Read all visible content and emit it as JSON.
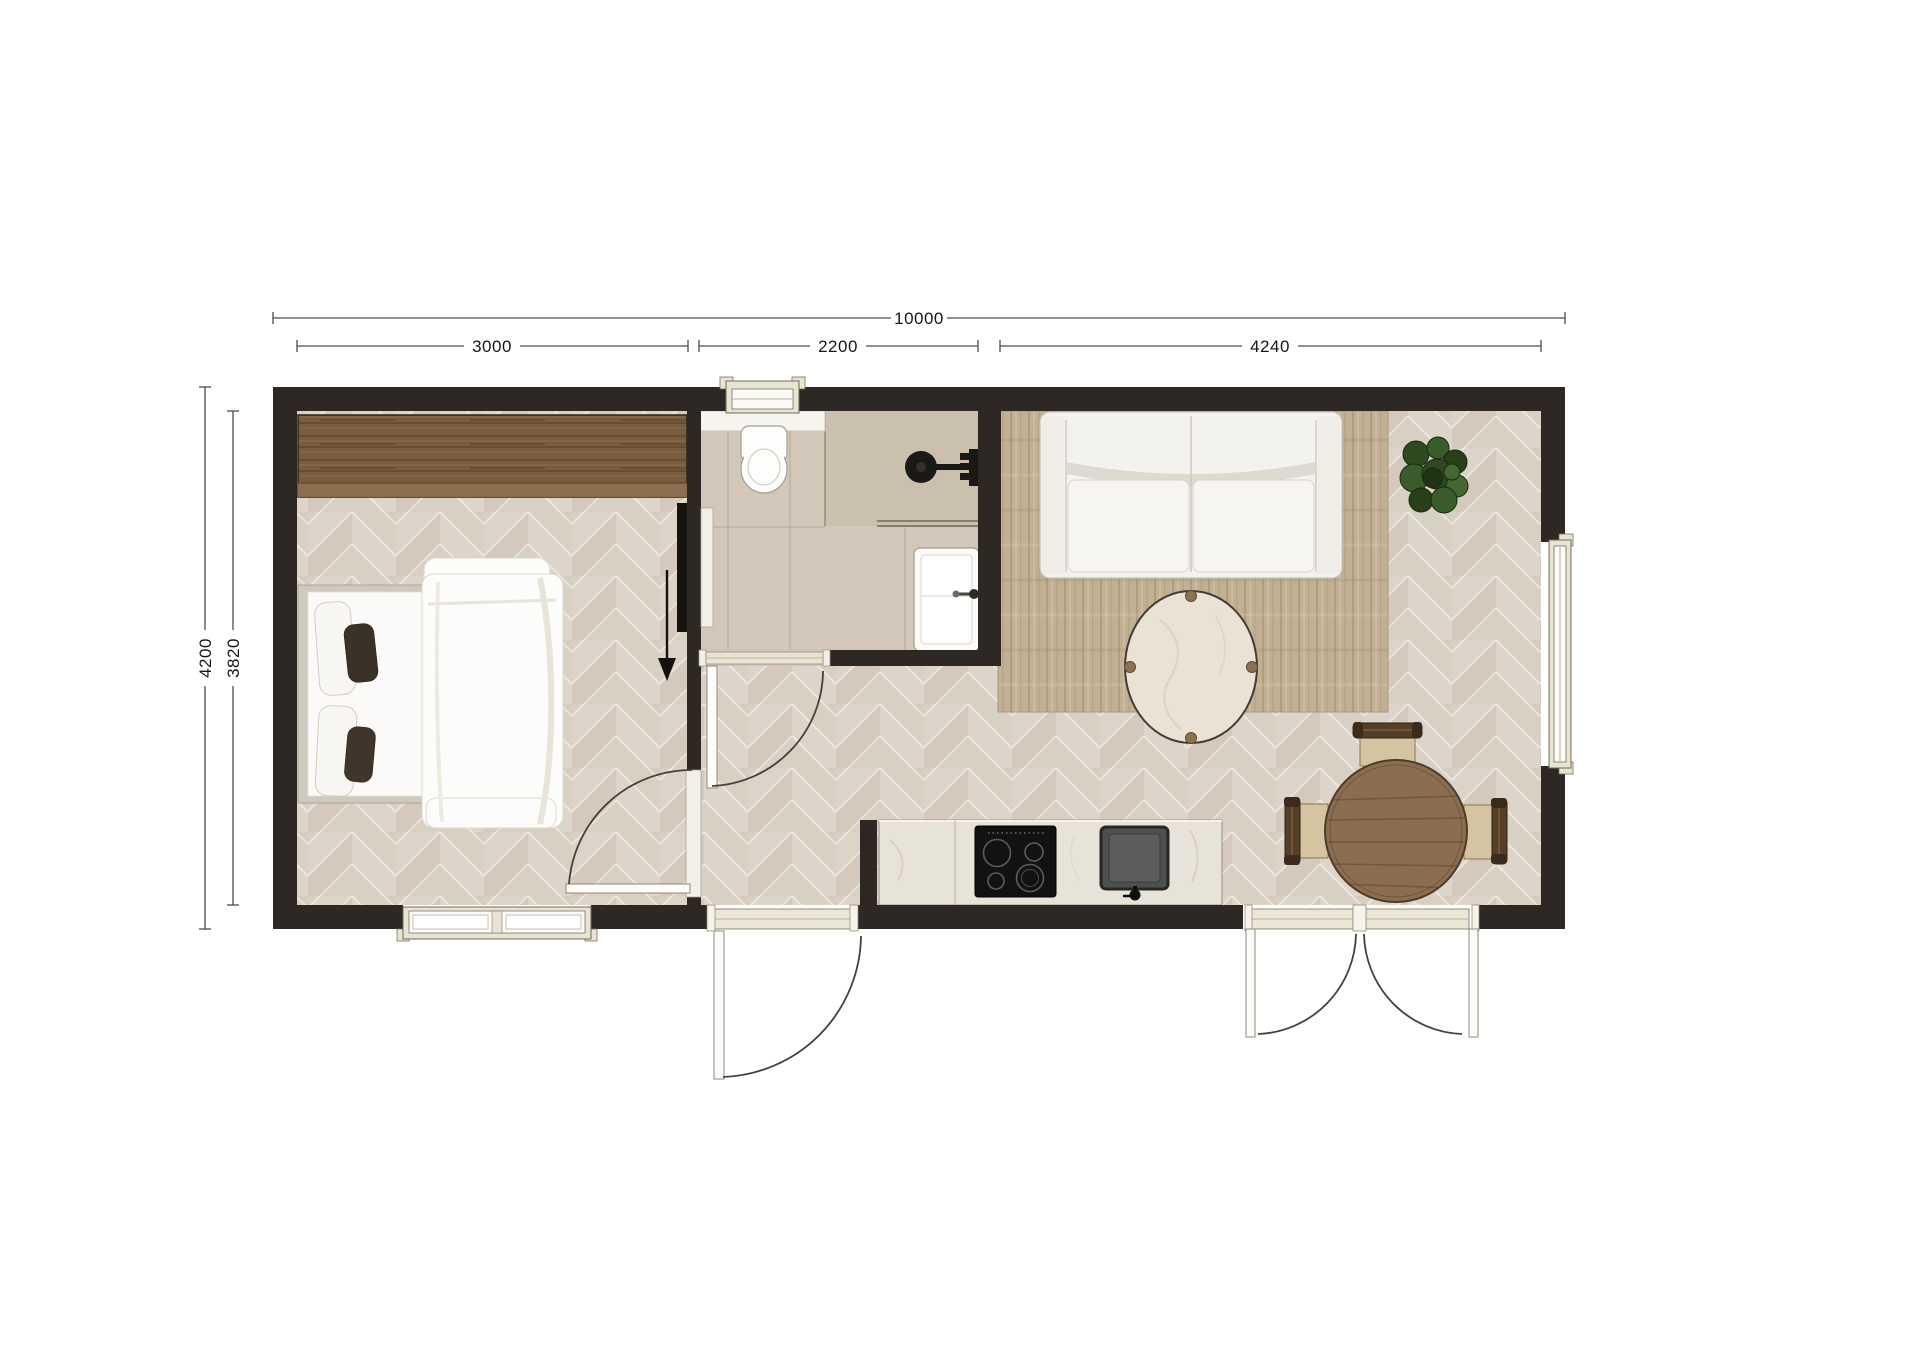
{
  "dimensions": {
    "overall_width": "10000",
    "width_segments": [
      {
        "label": "3000"
      },
      {
        "label": "2200"
      },
      {
        "label": "4240"
      }
    ],
    "overall_depth": "4200",
    "interior_depth": "3820"
  },
  "colors": {
    "background": "#ffffff",
    "wall": "#2d2824",
    "floor_base": "#d9d0c4",
    "floor_joint": "#ece6db",
    "bath_tile": "#d2c7b8",
    "shower_tile": "#cbc0ae",
    "rug": "#c2b094",
    "wardrobe_wood": "#7a5d3f",
    "table_wood": "#8b6e51",
    "chair_seat": "#d5c4a1",
    "counter_marble": "#e8e3d8",
    "appliance_black": "#121212",
    "sink_gray": "#4f4f4f",
    "fixture_white": "#fcfbf8",
    "window_frame": "#e9e3d2",
    "plant_green": "#2d4a21",
    "dimension_line": "#4c4c4c",
    "dimension_text": "#161616"
  }
}
